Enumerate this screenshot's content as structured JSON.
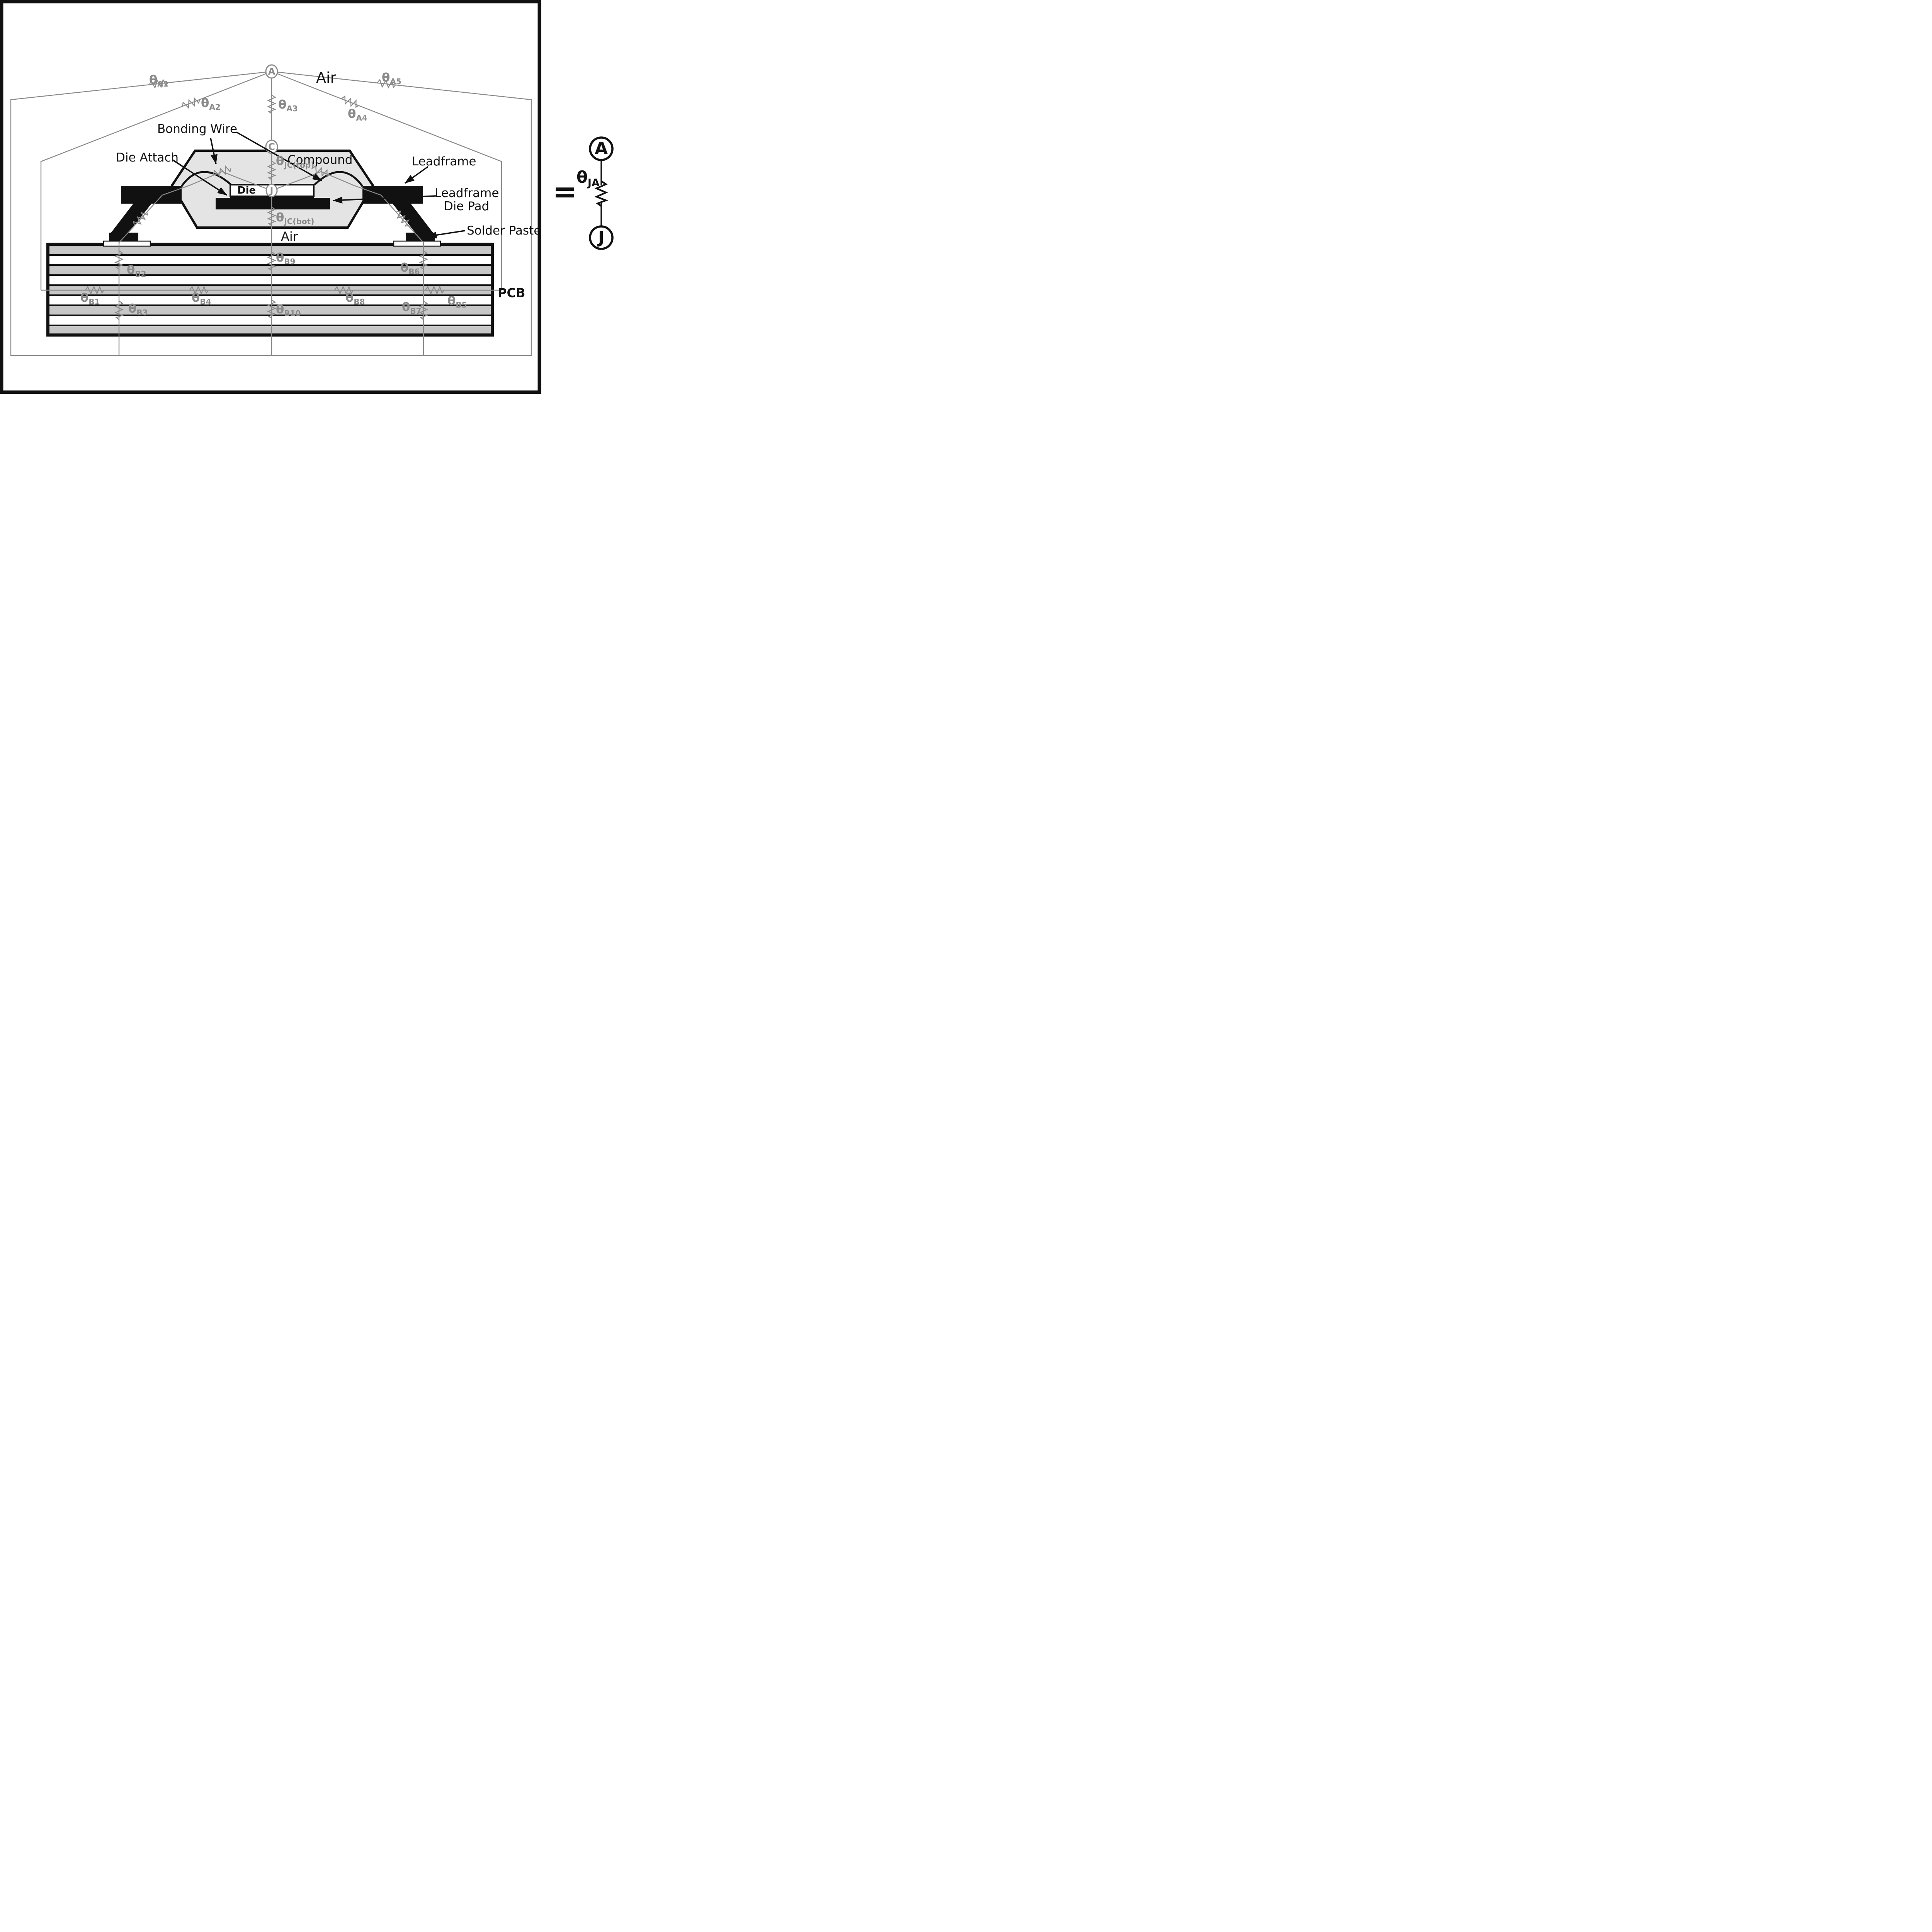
{
  "colors": {
    "line_black": "#111111",
    "network_gray": "#8a8a8a",
    "compound_gray": "#e4e4e4",
    "pcb_gray": "#c7c7c7",
    "background": "#ffffff"
  },
  "labels": {
    "air_top": "Air",
    "air_gap": "Air",
    "bonding_wire": "Bonding Wire",
    "die_attach": "Die Attach",
    "compound": "Compound",
    "leadframe": "Leadframe",
    "leadframe_die_pad_1": "Leadframe",
    "leadframe_die_pad_2": "Die Pad",
    "solder_paste": "Solder Paste",
    "pcb": "PCB",
    "die": "Die",
    "equals": "="
  },
  "nodes": {
    "ambient": "A",
    "case": "C",
    "junction": "J"
  },
  "equivalent": {
    "ambient": "A",
    "junction": "J"
  },
  "resistors": {
    "a1": {
      "theta": "θ",
      "sub": "A1"
    },
    "a2": {
      "theta": "θ",
      "sub": "A2"
    },
    "a3": {
      "theta": "θ",
      "sub": "A3"
    },
    "a4": {
      "theta": "θ",
      "sub": "A4"
    },
    "a5": {
      "theta": "θ",
      "sub": "A5"
    },
    "jc_top": {
      "theta": "θ",
      "sub": "JC(top)"
    },
    "jc_bot": {
      "theta": "θ",
      "sub": "JC(bot)"
    },
    "b1": {
      "theta": "θ",
      "sub": "B1"
    },
    "b2": {
      "theta": "θ",
      "sub": "B2"
    },
    "b3": {
      "theta": "θ",
      "sub": "B3"
    },
    "b4": {
      "theta": "θ",
      "sub": "B4"
    },
    "b5": {
      "theta": "θ",
      "sub": "B5"
    },
    "b6": {
      "theta": "θ",
      "sub": "B6"
    },
    "b7": {
      "theta": "θ",
      "sub": "B7"
    },
    "b8": {
      "theta": "θ",
      "sub": "B8"
    },
    "b9": {
      "theta": "θ",
      "sub": "B9"
    },
    "b10": {
      "theta": "θ",
      "sub": "B10"
    },
    "ja": {
      "theta": "θ",
      "sub": "JA"
    }
  }
}
